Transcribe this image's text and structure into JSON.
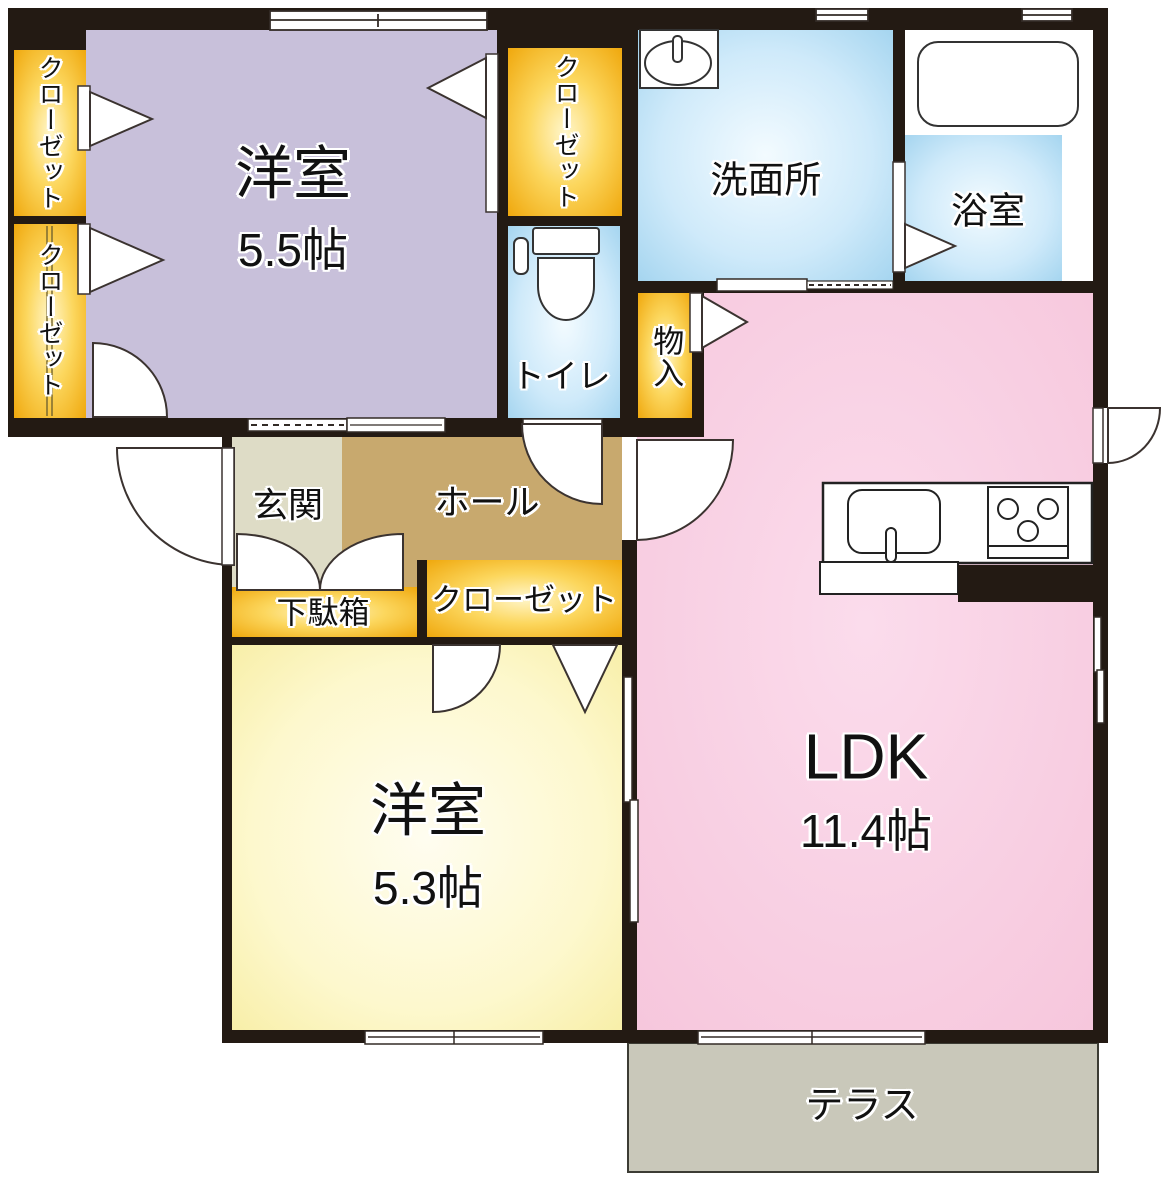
{
  "rooms": {
    "bedroom1": {
      "label": "洋室",
      "size": "5.5帖"
    },
    "bedroom2": {
      "label": "洋室",
      "size": "5.3帖"
    },
    "ldk": {
      "label": "LDK",
      "size": "11.4帖"
    },
    "washroom": {
      "label": "洗面所"
    },
    "bathroom": {
      "label": "浴室"
    },
    "toilet": {
      "label": "トイレ"
    },
    "storage": {
      "label": "物入"
    },
    "entrance": {
      "label": "玄関"
    },
    "hall": {
      "label": "ホール"
    },
    "shoe_cabinet": {
      "label": "下駄箱"
    },
    "closet_left_upper": {
      "label": "クローゼット"
    },
    "closet_left_lower": {
      "label": "クローゼット"
    },
    "closet_bedroom1": {
      "label": "クローゼット"
    },
    "closet_hall": {
      "label": "クローゼット"
    },
    "terrace": {
      "label": "テラス"
    }
  },
  "colors": {
    "wall": "#231a13",
    "bedroom1_fill": "#c8c0da",
    "bedroom2_fill": "#faf2b0",
    "ldk_fill": "#f7c9de",
    "water_fill": "#a5d7f0",
    "closet_fill": "#f0a60a",
    "entrance_fill": "#dedcc6",
    "hall_fill": "#c8a96e",
    "terrace_fill": "#c9c8ba"
  }
}
